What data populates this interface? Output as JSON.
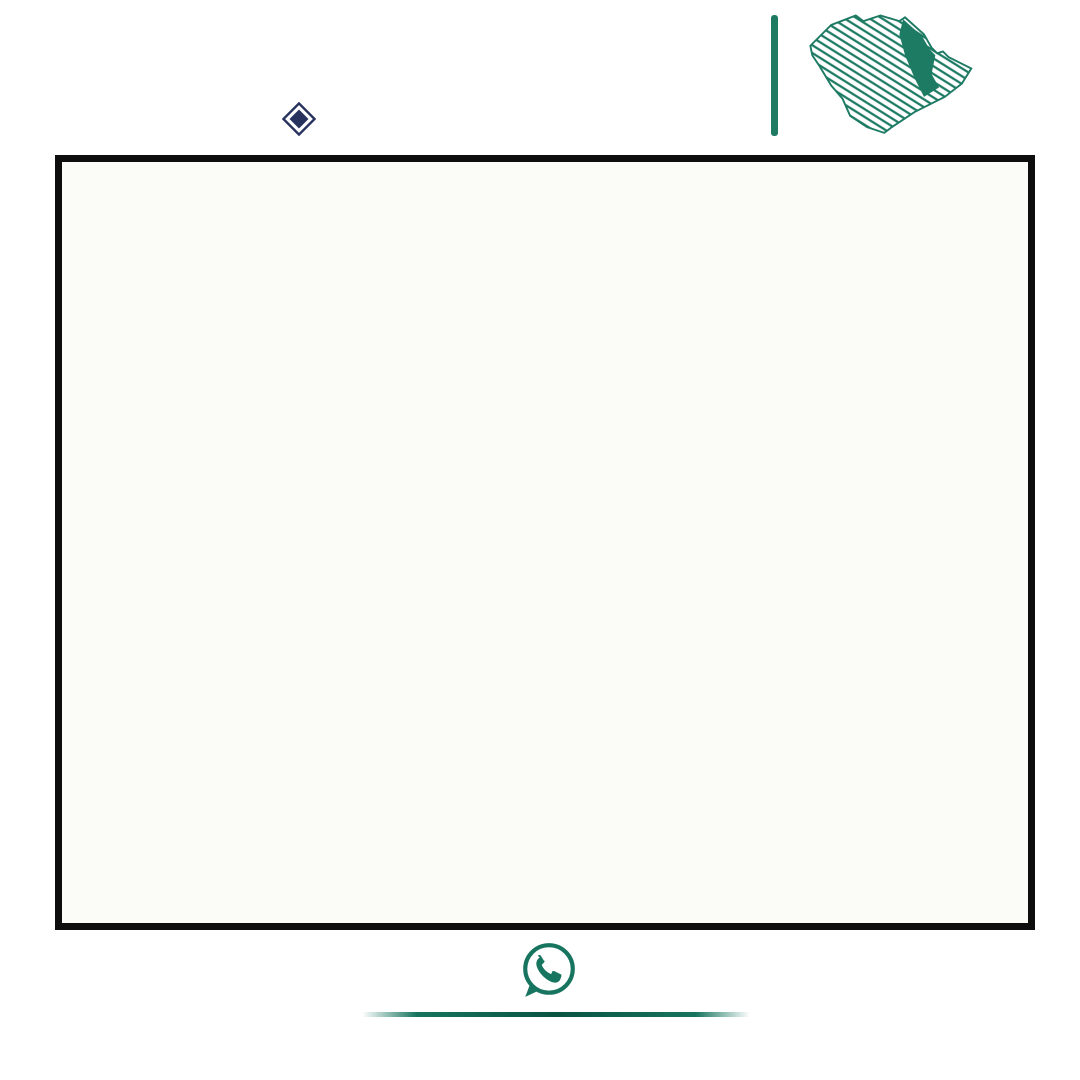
{
  "colors": {
    "green": "#1d7a63",
    "green_dark": "#17755f",
    "navy": "#27325f",
    "ink": "#2b2b2b",
    "red": "#e0251f"
  },
  "header": {
    "license_number": "1200008850",
    "classification_number": "658",
    "fal": {
      "latin": "FAL",
      "arabic": "فال",
      "license_word": "رخصة"
    },
    "authority": {
      "name": "الهيئة العامة للعقار",
      "latin": "REAL ESTATE GENERAL AUTHORITY",
      "sub": "تصنيف المنشآت العقارية"
    },
    "logo": {
      "arabic": "وطن للعقار",
      "english": "WATAN REAL ESTATE",
      "vertical_text": "شمعة"
    }
  },
  "footer": {
    "phone": "0508505505",
    "website": "watanaqar.com"
  },
  "map": {
    "street_labels": [
      {
        "t": "شارع",
        "x": 762,
        "y": 52,
        "s": 22
      },
      {
        "t": "عرض",
        "x": 606,
        "y": 47,
        "s": 22
      },
      {
        "t": "٢٠",
        "x": 443,
        "y": 58,
        "s": 20
      },
      {
        "t": "مـتر",
        "x": 294,
        "y": 46,
        "s": 20
      },
      {
        "t": "عـــرض",
        "x": 852,
        "y": 543,
        "s": 20
      },
      {
        "t": "٢٠",
        "x": 578,
        "y": 551,
        "s": 18
      },
      {
        "t": "مـتر",
        "x": 356,
        "y": 553,
        "s": 18
      }
    ],
    "markers": [
      {
        "t": "م ١٥",
        "x": 190,
        "y": 143
      },
      {
        "t": "م ١٥",
        "x": 408,
        "y": 252
      },
      {
        "t": "م ١٥",
        "x": 620,
        "y": 372
      },
      {
        "t": "م ١٥",
        "x": 218,
        "y": 468
      },
      {
        "t": "م ٢٠",
        "x": 405,
        "y": 428
      },
      {
        "t": "م ٢٠",
        "x": 755,
        "y": 617
      },
      {
        "t": "م ١٥",
        "x": 450,
        "y": 330,
        "r": 90
      },
      {
        "t": "م ١٥",
        "x": 889,
        "y": 115,
        "r": 90
      },
      {
        "t": "م ١٥",
        "x": 818,
        "y": 318,
        "r": 90
      },
      {
        "t": "م ١٥",
        "x": 900,
        "y": 330,
        "r": 90
      },
      {
        "t": "م ١٥",
        "x": 455,
        "y": 690,
        "r": 90
      },
      {
        "t": "م ١٥",
        "x": 700,
        "y": 688,
        "r": 90
      },
      {
        "t": "م ١٥",
        "x": 952,
        "y": 690,
        "r": 90
      }
    ],
    "hatches": [
      [
        623,
        72,
        20,
        56
      ],
      [
        608,
        133,
        18,
        54
      ],
      [
        898,
        64,
        13,
        68
      ],
      [
        692,
        185,
        18,
        58
      ],
      [
        825,
        353,
        70,
        10
      ],
      [
        825,
        462,
        70,
        9
      ],
      [
        907,
        390,
        73,
        10
      ],
      [
        730,
        386,
        78,
        8
      ],
      [
        343,
        518,
        88,
        14
      ],
      [
        487,
        437,
        16,
        55
      ],
      [
        487,
        500,
        16,
        48
      ],
      [
        97,
        500,
        66,
        10
      ],
      [
        270,
        363,
        270,
        9
      ],
      [
        397,
        372,
        15,
        30
      ],
      [
        743,
        728,
        175,
        8
      ],
      [
        820,
        736,
        15,
        39
      ]
    ],
    "blocks": [
      {
        "x": 85,
        "y": 75,
        "w": 235,
        "h": 55,
        "rows": [
          [
            249,
            247,
            245,
            243,
            241
          ],
          [
            250,
            248,
            246,
            244,
            242
          ]
        ]
      },
      {
        "x": 370,
        "y": 78,
        "w": 92,
        "h": 130,
        "rows": [
          [
            88,
            87
          ],
          [
            90,
            89
          ],
          [
            92,
            91
          ],
          [
            94,
            93
          ],
          [
            86,
            85
          ]
        ]
      },
      {
        "x": 488,
        "y": 75,
        "w": 132,
        "h": 53,
        "rows": [
          [
            49,
            47,
            45,
            43,
            41
          ],
          [
            50,
            48,
            46,
            44,
            42
          ]
        ]
      },
      {
        "x": 645,
        "y": 70,
        "w": 235,
        "h": 55,
        "rows": [
          [
            29,
            27,
            25,
            23,
            21,
            19,
            17,
            15,
            13,
            11
          ],
          [
            30,
            28,
            26,
            24,
            22,
            20,
            18,
            16,
            14,
            12
          ]
        ]
      },
      {
        "x": 912,
        "y": 62,
        "w": 66,
        "h": 115,
        "rows": [
          [
            2,
            1
          ],
          [
            4,
            3
          ],
          [
            6,
            5
          ],
          [
            8,
            7
          ],
          [
            10,
            9
          ]
        ]
      },
      {
        "x": 488,
        "y": 136,
        "w": 132,
        "h": 52,
        "rows": [
          [
            75,
            73,
            71,
            69
          ],
          [
            76,
            74,
            72,
            70
          ]
        ]
      },
      {
        "x": 645,
        "y": 133,
        "w": 235,
        "h": 54,
        "rows": [
          [
            67,
            65,
            63,
            61,
            59,
            57,
            55,
            53,
            51
          ],
          [
            68,
            66,
            64,
            62,
            60,
            58,
            56,
            54,
            52
          ]
        ]
      },
      {
        "x": 65,
        "y": 135,
        "w": 88,
        "h": 268,
        "rows": [
          [
            272,
            271
          ],
          [
            274,
            273
          ],
          [
            276,
            275
          ],
          [
            278,
            277
          ],
          "H",
          [
            280,
            279
          ],
          [
            282,
            281
          ],
          [
            284,
            283
          ],
          [
            286,
            285
          ],
          [
            288,
            287
          ],
          [
            290,
            289
          ],
          [
            292,
            291
          ]
        ]
      },
      {
        "x": 175,
        "y": 175,
        "w": 86,
        "h": 228,
        "rows": [
          [
            252,
            251
          ],
          [
            254,
            253
          ],
          [
            256,
            255
          ],
          [
            258,
            257
          ],
          [
            260,
            259
          ],
          [
            262,
            261
          ],
          [
            264,
            263
          ],
          [
            266,
            265
          ],
          [
            268,
            267
          ],
          [
            270,
            269
          ]
        ]
      },
      {
        "x": 465,
        "y": 243,
        "w": 80,
        "h": 188,
        "rows": [
          [
            302,
            301
          ],
          [
            304,
            303
          ],
          [
            306,
            305
          ],
          [
            308,
            307
          ],
          "H",
          [
            310,
            309
          ],
          [
            312,
            311
          ],
          [
            314,
            313
          ],
          [
            316,
            315
          ],
          [
            318,
            317
          ]
        ]
      },
      {
        "x": 330,
        "y": 185,
        "w": 360,
        "h": 58,
        "highlight": 224,
        "rows": [
          [
            225,
            223,
            221,
            219,
            217,
            215,
            213,
            211
          ],
          [
            226,
            224,
            222,
            220,
            218,
            216,
            214,
            212
          ]
        ]
      },
      {
        "x": 712,
        "y": 185,
        "w": 106,
        "h": 58,
        "rows": [
          [
            209,
            207,
            205
          ],
          [
            210,
            208,
            206
          ]
        ]
      },
      {
        "x": 822,
        "y": 183,
        "w": 158,
        "h": 57,
        "rows": [
          [
            105,
            103,
            101,
            99,
            97
          ],
          [
            106,
            104,
            102,
            100,
            98
          ]
        ]
      },
      {
        "x": 825,
        "y": 252,
        "w": 70,
        "h": 100,
        "rows": [
          [
            122,
            121
          ],
          [
            124,
            123
          ],
          [
            126,
            125
          ],
          [
            128,
            127
          ],
          [
            130,
            129
          ],
          [
            132,
            131
          ]
        ]
      },
      {
        "x": 825,
        "y": 364,
        "w": 70,
        "h": 97,
        "rows": [
          [
            144,
            143
          ],
          [
            146,
            145
          ],
          [
            148,
            147
          ],
          [
            150,
            149
          ],
          [
            152,
            151
          ]
        ]
      },
      {
        "x": 825,
        "y": 472,
        "w": 70,
        "h": 70,
        "rows": [
          [
            172,
            171
          ],
          [
            174,
            173
          ],
          [
            176,
            175
          ]
        ]
      },
      {
        "x": 907,
        "y": 242,
        "w": 73,
        "h": 148,
        "rows": [
          [
            108,
            107
          ],
          [
            110,
            109
          ],
          [
            112,
            111
          ],
          [
            114,
            113
          ],
          [
            116,
            115
          ],
          [
            118,
            117
          ],
          [
            120,
            119
          ]
        ]
      },
      {
        "x": 907,
        "y": 401,
        "w": 73,
        "h": 111,
        "rows": [
          [
            134,
            133
          ],
          [
            136,
            135
          ],
          [
            138,
            137
          ],
          [
            140,
            139
          ],
          [
            142,
            141
          ]
        ]
      },
      {
        "x": 730,
        "y": 242,
        "w": 78,
        "h": 143,
        "rows": [
          [
            174,
            173
          ],
          [
            176,
            175
          ],
          [
            178,
            177
          ],
          [
            180,
            179
          ],
          [
            182,
            181
          ],
          [
            184,
            183
          ],
          [
            186,
            185
          ]
        ]
      },
      {
        "x": 730,
        "y": 394,
        "w": 78,
        "h": 150,
        "rows": [
          [
            156,
            155
          ],
          [
            158,
            157
          ],
          [
            160,
            159
          ],
          [
            162,
            161
          ],
          [
            164,
            163
          ],
          [
            166,
            165
          ],
          [
            168,
            167
          ]
        ]
      },
      {
        "x": 97,
        "y": 437,
        "w": 66,
        "h": 55,
        "rows": [
          [
            362,
            361
          ],
          [
            364,
            363
          ]
        ]
      },
      {
        "x": 273,
        "y": 437,
        "w": 214,
        "h": 55,
        "rows": [
          [
            347,
            345,
            343,
            341,
            339,
            337
          ],
          [
            348,
            346,
            344,
            342,
            340,
            338
          ]
        ]
      },
      {
        "x": 235,
        "y": 500,
        "w": 252,
        "h": 48,
        "rows": [
          [
            359,
            357,
            355,
            353,
            351,
            349
          ],
          [
            360,
            358,
            356,
            354,
            352,
            350
          ]
        ]
      },
      {
        "x": 100,
        "y": 567,
        "w": 243,
        "h": 46,
        "rows": [
          [
            179,
            177,
            175,
            173,
            171,
            169,
            167,
            165,
            163,
            161
          ],
          [
            180,
            178,
            176,
            174,
            172,
            170,
            168,
            166,
            164,
            162
          ]
        ]
      },
      {
        "x": 455,
        "y": 565,
        "w": 220,
        "h": 48,
        "rows": [
          [
            51,
            49,
            47,
            45,
            43,
            41,
            39,
            37
          ],
          [
            52,
            50,
            48,
            46,
            44,
            42,
            40,
            38
          ]
        ]
      },
      {
        "x": 700,
        "y": 563,
        "w": 212,
        "h": 50,
        "rows": [
          [
            35,
            33,
            31,
            29,
            27,
            25
          ],
          [
            36,
            34,
            32,
            30,
            28,
            26
          ]
        ]
      },
      {
        "x": 925,
        "y": 563,
        "w": 55,
        "h": 50,
        "rows": [
          [
            23,
            21
          ],
          [
            24,
            22
          ]
        ]
      },
      {
        "x": 100,
        "y": 628,
        "w": 67,
        "h": 144,
        "rows": [
          [
            228,
            227
          ],
          [
            230,
            229
          ],
          [
            232,
            231
          ],
          [
            234,
            233
          ],
          [
            236,
            235
          ],
          [
            238,
            237
          ],
          [
            240,
            239
          ]
        ]
      },
      {
        "x": 192,
        "y": 628,
        "w": 66,
        "h": 144,
        "rows": [
          [
            200,
            199
          ],
          [
            202,
            201
          ],
          [
            204,
            203
          ],
          [
            206,
            205
          ],
          [
            208,
            207
          ],
          [
            210,
            209
          ],
          [
            212,
            211
          ]
        ]
      },
      {
        "x": 277,
        "y": 628,
        "w": 66,
        "h": 144,
        "rows": [
          [
            182,
            181
          ],
          [
            184,
            183
          ],
          [
            186,
            185
          ],
          [
            188,
            187
          ],
          [
            190,
            189
          ],
          [
            192,
            191
          ],
          [
            194,
            193
          ]
        ]
      },
      {
        "x": 372,
        "y": 565,
        "w": 63,
        "h": 207,
        "rows": [
          [
            52,
            51
          ],
          [
            54,
            53
          ],
          [
            56,
            55
          ],
          [
            58,
            57
          ],
          [
            60,
            59
          ],
          [
            62,
            61
          ],
          [
            64,
            63
          ],
          [
            66,
            65
          ],
          [
            68,
            67
          ],
          [
            70,
            69
          ]
        ]
      }
    ],
    "labels": {
      "parking": "انـتـظـار سـيـارات",
      "garden": "حديقة",
      "mosque": "مسجد",
      "market": "سوق محلي",
      "neighborhood_h": "مجاورة ٣ (ح)",
      "neighborhood_d": "مجاورة ٣ (د)",
      "school_boys_elem": [
        "مدرسة",
        "ابتدائية",
        "بنين"
      ],
      "school_girls_mid": [
        "مدرسة",
        "متوسطة",
        "بنات"
      ],
      "school_boys_both": [
        "مدرسة",
        "ابتدائية",
        "ومتوسطة",
        "بنين"
      ]
    }
  }
}
